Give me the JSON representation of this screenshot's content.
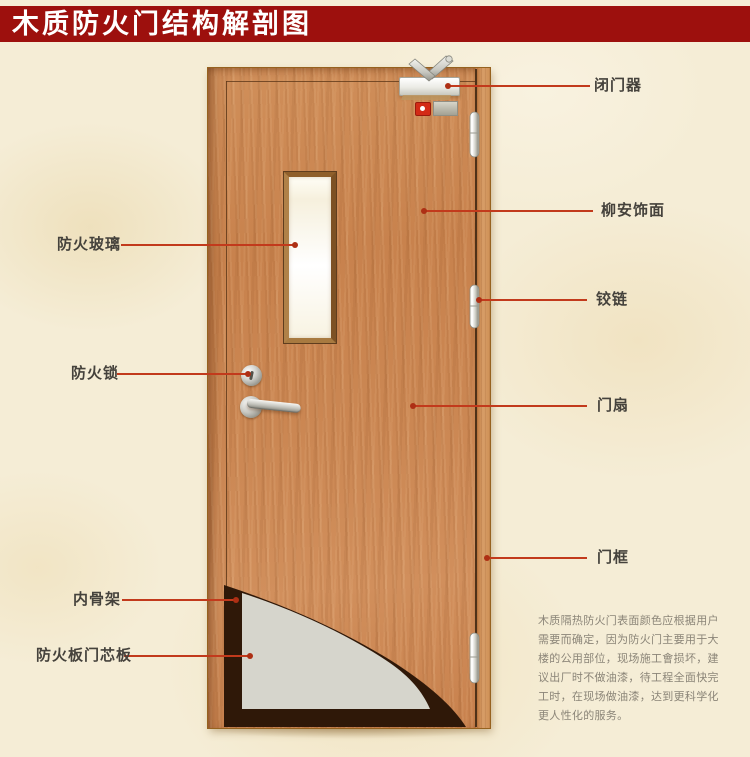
{
  "header": {
    "title": "木质防火门结构解剖图",
    "bar_color": "#9d100d",
    "text_color": "#ffffff"
  },
  "annotations": {
    "closer": {
      "label": "闭门器"
    },
    "veneer": {
      "label": "柳安饰面"
    },
    "hinge": {
      "label": "铰链"
    },
    "leaf": {
      "label": "门扇"
    },
    "frame": {
      "label": "门框"
    },
    "glass": {
      "label": "防火玻璃"
    },
    "lock": {
      "label": "防火锁"
    },
    "skeleton": {
      "label": "内骨架"
    },
    "core": {
      "label": "防火板门芯板"
    }
  },
  "description": {
    "lines": [
      "木质隔热防火门表面颜色应根据用户",
      "需要而确定，因为防火门主要用于大",
      "楼的公用部位，现场施工會损坏，建",
      "议出厂时不做油漆，待工程全面快完",
      "工时，在现场做油漆，达到更科学化",
      "更人性化的服务。"
    ]
  },
  "colors": {
    "background": "#f5edd6",
    "leader_line": "#c23a1c",
    "wood": "#c9854f",
    "core_panel": "#d6d5cc",
    "skeleton_dark": "#2f1808"
  }
}
